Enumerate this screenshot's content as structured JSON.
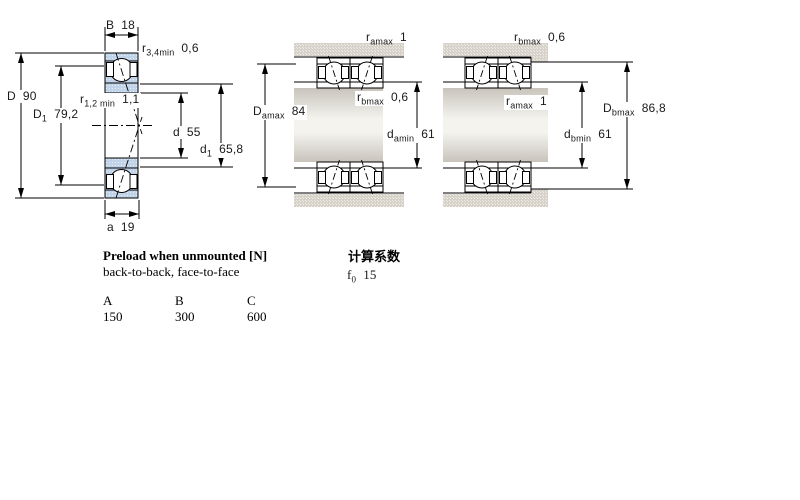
{
  "left_diagram": {
    "dims": {
      "B": {
        "base": "B",
        "value": "18"
      },
      "r34min": {
        "base": "r",
        "sub": "3,4min",
        "value": "0,6"
      },
      "D": {
        "base": "D",
        "value": "90"
      },
      "D1": {
        "base": "D",
        "sub": "1",
        "value": "79,2"
      },
      "r12min": {
        "base": "r",
        "sub": "1,2 min",
        "value": "1,1"
      },
      "d": {
        "base": "d",
        "value": "55"
      },
      "d1": {
        "base": "d",
        "sub": "1",
        "value": "65,8"
      },
      "a": {
        "base": "a",
        "value": "19"
      }
    }
  },
  "middle_diagram": {
    "arrangement": "back-to-back",
    "dims": {
      "ramax": {
        "base": "r",
        "sub": "amax",
        "value": "1"
      },
      "Damax": {
        "base": "D",
        "sub": "amax",
        "value": "84"
      },
      "rbmax": {
        "base": "r",
        "sub": "bmax",
        "value": "0,6"
      },
      "damin": {
        "base": "d",
        "sub": "amin",
        "value": "61"
      }
    }
  },
  "right_diagram": {
    "arrangement": "face-to-face",
    "dims": {
      "rbmax": {
        "base": "r",
        "sub": "bmax",
        "value": "0,6"
      },
      "ramax": {
        "base": "r",
        "sub": "amax",
        "value": "1"
      },
      "Dbmax": {
        "base": "D",
        "sub": "bmax",
        "value": "86,8"
      },
      "dbmin": {
        "base": "d",
        "sub": "bmin",
        "value": "61"
      }
    }
  },
  "preload": {
    "title": "Preload when unmounted [N]",
    "subtitle": "back-to-back, face-to-face",
    "columns": [
      "A",
      "B",
      "C"
    ],
    "values": [
      "150",
      "300",
      "600"
    ]
  },
  "calculation": {
    "title": "计算系数",
    "f0": {
      "base": "f",
      "sub": "0",
      "value": "15"
    }
  },
  "colors": {
    "line": "#000000",
    "ring_fill": "#c1d3e8",
    "ring_dot": "#e6edf6",
    "housing_fill": "#d6d2ca",
    "housing_dot": "#f0efe9",
    "shaft_dark": "#c8c4bc",
    "shaft_light": "#f4f3ee",
    "background": "#ffffff"
  }
}
